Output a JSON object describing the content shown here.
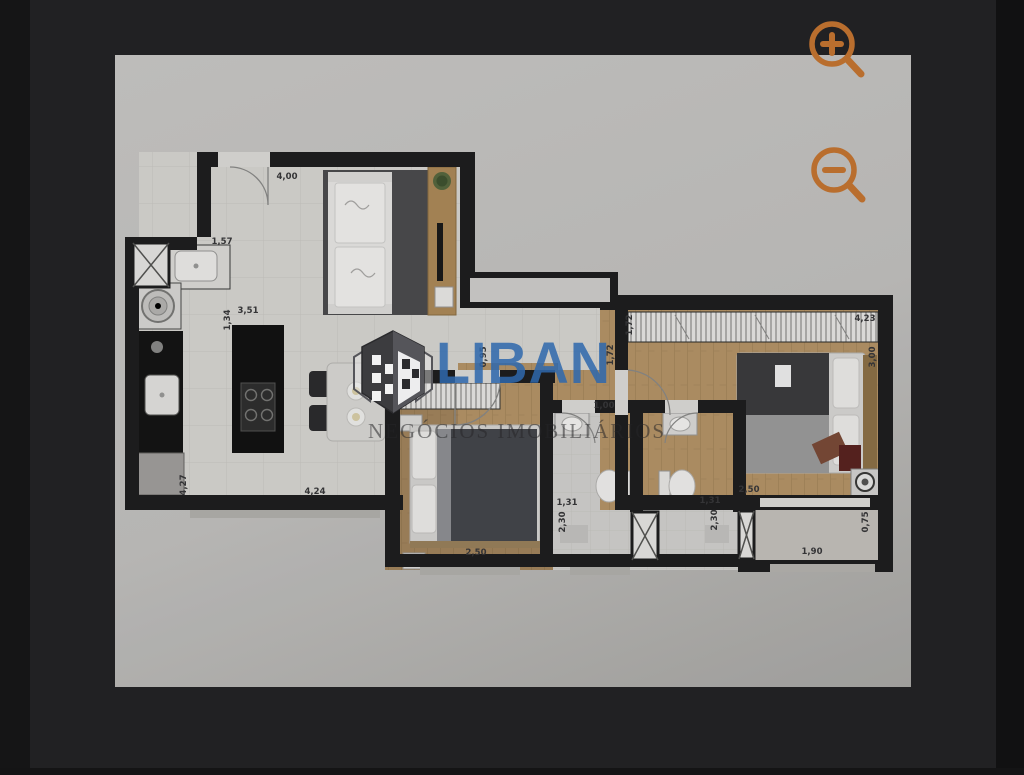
{
  "viewer": {
    "background_color": "#212123",
    "frame_color": "#141415",
    "canvas_color": "#c3c2c0",
    "accent_color": "#b96e2e",
    "zoom_in_icon": "magnifier-plus-icon",
    "zoom_out_icon": "magnifier-minus-icon"
  },
  "watermark": {
    "brand": "LIBAN",
    "tagline": "NEGÓCIOS IMOBILIÁRIOS",
    "brand_color": "#2f68ac",
    "logo": "liban-isometric-building-logo"
  },
  "floorplan": {
    "dimension_unit": "m",
    "dimensions": [
      {
        "text": "4,00",
        "x": 172,
        "y": 124,
        "rot": 0
      },
      {
        "text": "1,57",
        "x": 107,
        "y": 189,
        "rot": 0
      },
      {
        "text": "3,51",
        "x": 133,
        "y": 258,
        "rot": 0
      },
      {
        "text": "1,34",
        "x": 115,
        "y": 265,
        "rot": -90
      },
      {
        "text": "4,27",
        "x": 71,
        "y": 430,
        "rot": -90
      },
      {
        "text": "4,24",
        "x": 200,
        "y": 439,
        "rot": 0
      },
      {
        "text": "0,95",
        "x": 371,
        "y": 302,
        "rot": -90
      },
      {
        "text": "1,72",
        "x": 517,
        "y": 270,
        "rot": -90
      },
      {
        "text": "1,72",
        "x": 498,
        "y": 300,
        "rot": -90
      },
      {
        "text": "4,23",
        "x": 750,
        "y": 266,
        "rot": 0
      },
      {
        "text": "3,00",
        "x": 760,
        "y": 302,
        "rot": -90
      },
      {
        "text": "1,00",
        "x": 489,
        "y": 353,
        "rot": 0
      },
      {
        "text": "2,50",
        "x": 634,
        "y": 437,
        "rot": 0
      },
      {
        "text": "1,31",
        "x": 595,
        "y": 448,
        "rot": 0
      },
      {
        "text": "2,30",
        "x": 602,
        "y": 465,
        "rot": -90
      },
      {
        "text": "1,31",
        "x": 452,
        "y": 450,
        "rot": 0
      },
      {
        "text": "2,30",
        "x": 450,
        "y": 467,
        "rot": -90
      },
      {
        "text": "2,50",
        "x": 361,
        "y": 500,
        "rot": 0
      },
      {
        "text": "1,90",
        "x": 697,
        "y": 499,
        "rot": 0
      },
      {
        "text": "0,75",
        "x": 753,
        "y": 467,
        "rot": -90
      }
    ]
  }
}
